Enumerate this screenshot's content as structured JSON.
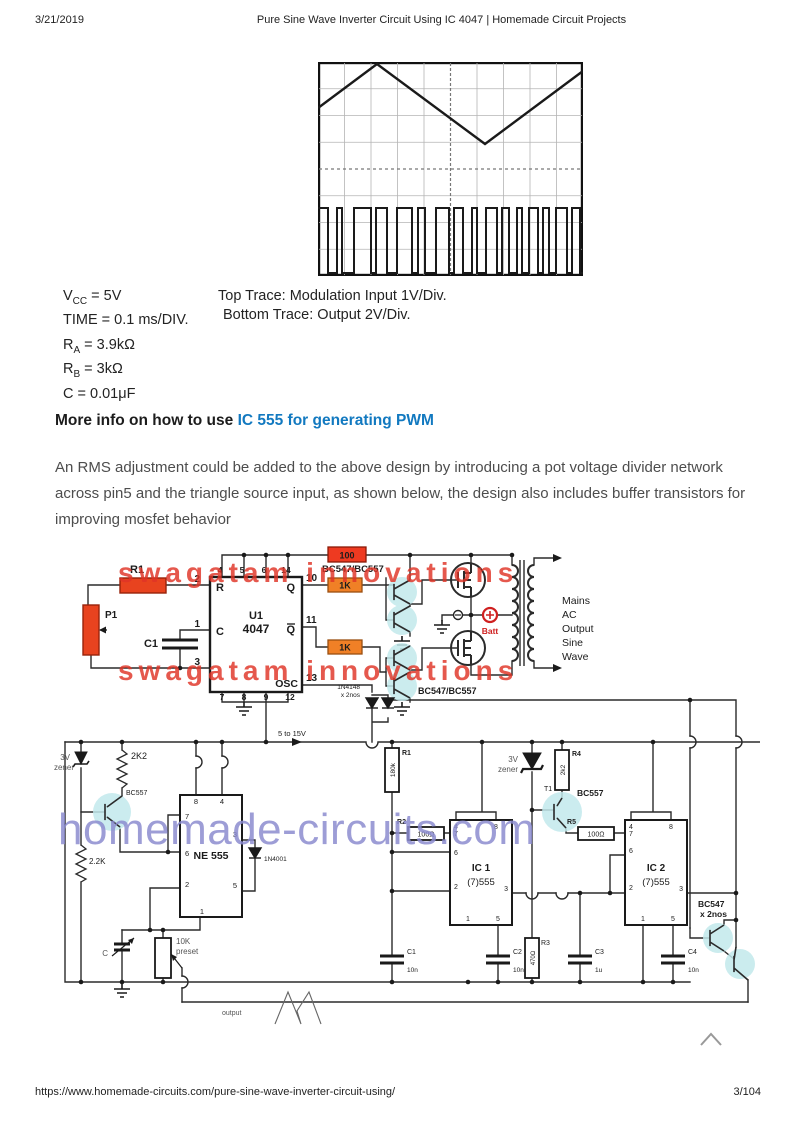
{
  "page": {
    "date": "3/21/2019",
    "title": "Pure Sine Wave Inverter Circuit Using IC 4047 | Homemade Circuit Projects",
    "url": "https://www.homemade-circuits.com/pure-sine-wave-inverter-circuit-using/",
    "page_num": "3/104"
  },
  "scope_specs": {
    "lines": [
      {
        "b": "V",
        "s": "CC",
        "r": " = 5V"
      },
      {
        "b": "TIME",
        "s": "",
        "r": " = 0.1 ms/DIV."
      },
      {
        "b": "R",
        "s": "A",
        "r": " = 3.9kΩ"
      },
      {
        "b": "R",
        "s": "B",
        "r": " = 3kΩ"
      },
      {
        "b": "C",
        "s": "",
        "r": " = 0.01μF"
      }
    ],
    "trace_top": "Top Trace: Modulation Input 1V/Div.",
    "trace_bottom": "Bottom Trace: Output 2V/Div."
  },
  "article": {
    "heading_prefix": "More info on how to use",
    "heading_link": "IC 555 for generating PWM",
    "paragraph": "An RMS adjustment could be added to the above design by introducing a pot voltage divider network across pin5 and the triangle source input, as shown below, the design also includes buffer transistors for improving mosfet behavior"
  },
  "circuit": {
    "watermark_red": "swagatam innovations",
    "watermark_purple": "homemade-circuits.com",
    "u1": {
      "name": "U1",
      "part": "4047",
      "pins_top": [
        "4",
        "5",
        "6",
        "14"
      ],
      "pins_bottom": [
        "7",
        "8",
        "9",
        "12"
      ],
      "pin2": "2",
      "pin1": "1",
      "pin3": "3",
      "pin10": "10",
      "pin11": "11",
      "pin13": "13",
      "r": "R",
      "c": "C",
      "q": "Q",
      "qb": "Q",
      "osc": "OSC"
    },
    "r1": "R1",
    "p1": "P1",
    "c1": "C1",
    "r100": "100",
    "bc_pair_top": "BC547/BC557",
    "k1": "1K",
    "k2": "1K",
    "d_4148": "1N4148",
    "d_4148b": "x 2nos",
    "bc_pair_bottom": "BC547/BC557",
    "batt": "Batt",
    "supply": "5 to 15V",
    "out_lines": [
      "Mains",
      "AC",
      "Output",
      "Sine",
      "Wave"
    ],
    "zener1": [
      "3V",
      "zener"
    ],
    "r_2k2": "2K2",
    "bc557_left": "BC557",
    "r_22k": "2.2K",
    "ne555": {
      "name": "NE 555",
      "p8": "8",
      "p4": "4",
      "p7": "7",
      "p6": "6",
      "p2": "2",
      "p3": "3",
      "p5": "5",
      "p1": "1"
    },
    "d_4001": "1N4001",
    "cap_c": "C",
    "preset": [
      "10K",
      "preset"
    ],
    "r180": {
      "name": "R1",
      "val": "180k"
    },
    "zener2": [
      "3V",
      "zener"
    ],
    "r4": {
      "name": "R4",
      "val": "2k2"
    },
    "t1": "T1",
    "bc557_right": "BC557",
    "r2": {
      "name": "R2",
      "val": "100Ω"
    },
    "r5": {
      "name": "R5",
      "val": "100Ω"
    },
    "ic1": {
      "name": "IC 1",
      "part": "(7)555",
      "p4": "4",
      "p8": "8",
      "p7": "7",
      "p6": "6",
      "p2": "2",
      "p3": "3",
      "p1": "1",
      "p5": "5"
    },
    "ic2": {
      "name": "IC 2",
      "part": "(7)555",
      "p4": "4",
      "p8": "8",
      "p7": "7",
      "p6": "6",
      "p2": "2",
      "p3": "3",
      "p1": "1",
      "p5": "5"
    },
    "bc547_pair": [
      "BC547",
      "x 2nos"
    ],
    "cb1": {
      "name": "C1",
      "val": "10n"
    },
    "cb2": {
      "name": "C2",
      "val": "10n"
    },
    "r3": {
      "name": "R3",
      "val": "470Ω"
    },
    "cb3": {
      "name": "C3",
      "val": "1u"
    },
    "cb4": {
      "name": "C4",
      "val": "10n"
    },
    "output": "output"
  }
}
